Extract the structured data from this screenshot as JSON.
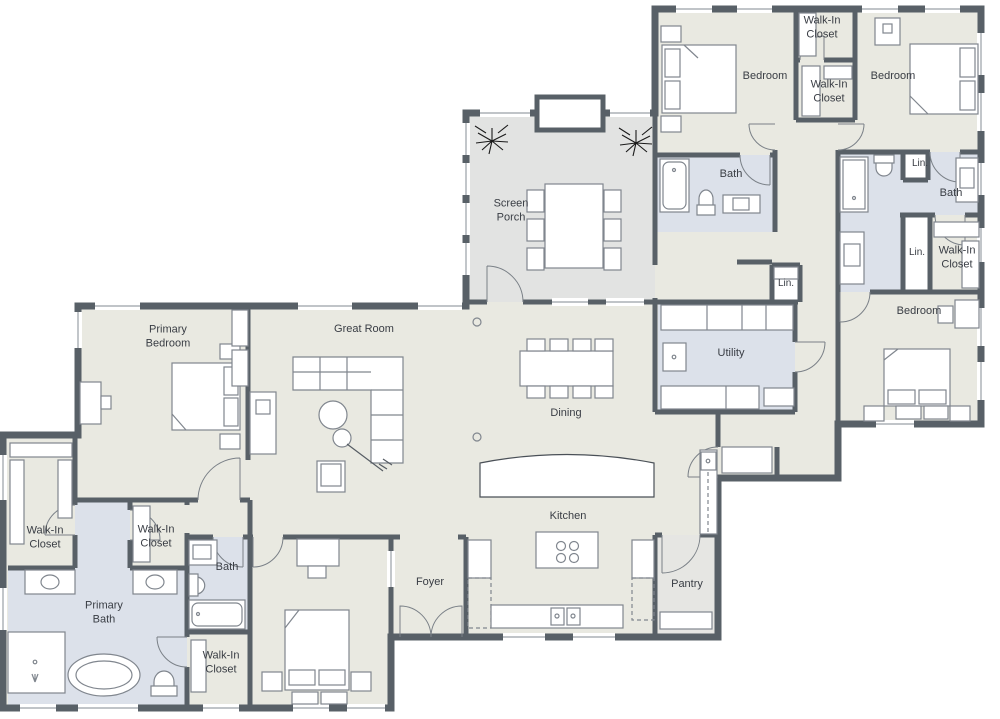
{
  "colors": {
    "wall": "#586067",
    "floor": "#e9e9e1",
    "wet_room": "#dce1ea",
    "screen_porch": "#e2e3e2",
    "pantry": "#e6e6e3",
    "background": "#ffffff",
    "label_text": "#393d44"
  },
  "rooms": [
    {
      "id": "walk-in-closet-top",
      "label": "Walk-In Closet"
    },
    {
      "id": "bedroom-top-left",
      "label": "Bedroom"
    },
    {
      "id": "walk-in-closet-upper",
      "label": "Walk-In Closet"
    },
    {
      "id": "bedroom-top-right",
      "label": "Bedroom"
    },
    {
      "id": "bath-top",
      "label": "Bath"
    },
    {
      "id": "linen-top",
      "label": "Lin."
    },
    {
      "id": "bath-right",
      "label": "Bath"
    },
    {
      "id": "screen-porch",
      "label": "Screen Porch"
    },
    {
      "id": "linen-hall",
      "label": "Lin."
    },
    {
      "id": "linen-right",
      "label": "Lin."
    },
    {
      "id": "walk-in-closet-right",
      "label": "Walk-In Closet"
    },
    {
      "id": "primary-bedroom",
      "label": "Primary Bedroom"
    },
    {
      "id": "great-room",
      "label": "Great Room"
    },
    {
      "id": "utility",
      "label": "Utility"
    },
    {
      "id": "bedroom-right",
      "label": "Bedroom"
    },
    {
      "id": "dining",
      "label": "Dining"
    },
    {
      "id": "kitchen",
      "label": "Kitchen"
    },
    {
      "id": "walk-in-closet-left",
      "label": "Walk-In Closet"
    },
    {
      "id": "walk-in-closet-mid",
      "label": "Walk-In Closet"
    },
    {
      "id": "bath-left",
      "label": "Bath"
    },
    {
      "id": "primary-bath",
      "label": "Primary Bath"
    },
    {
      "id": "foyer",
      "label": "Foyer"
    },
    {
      "id": "pantry",
      "label": "Pantry"
    },
    {
      "id": "walk-in-closet-bottom",
      "label": "Walk-In Closet"
    }
  ]
}
